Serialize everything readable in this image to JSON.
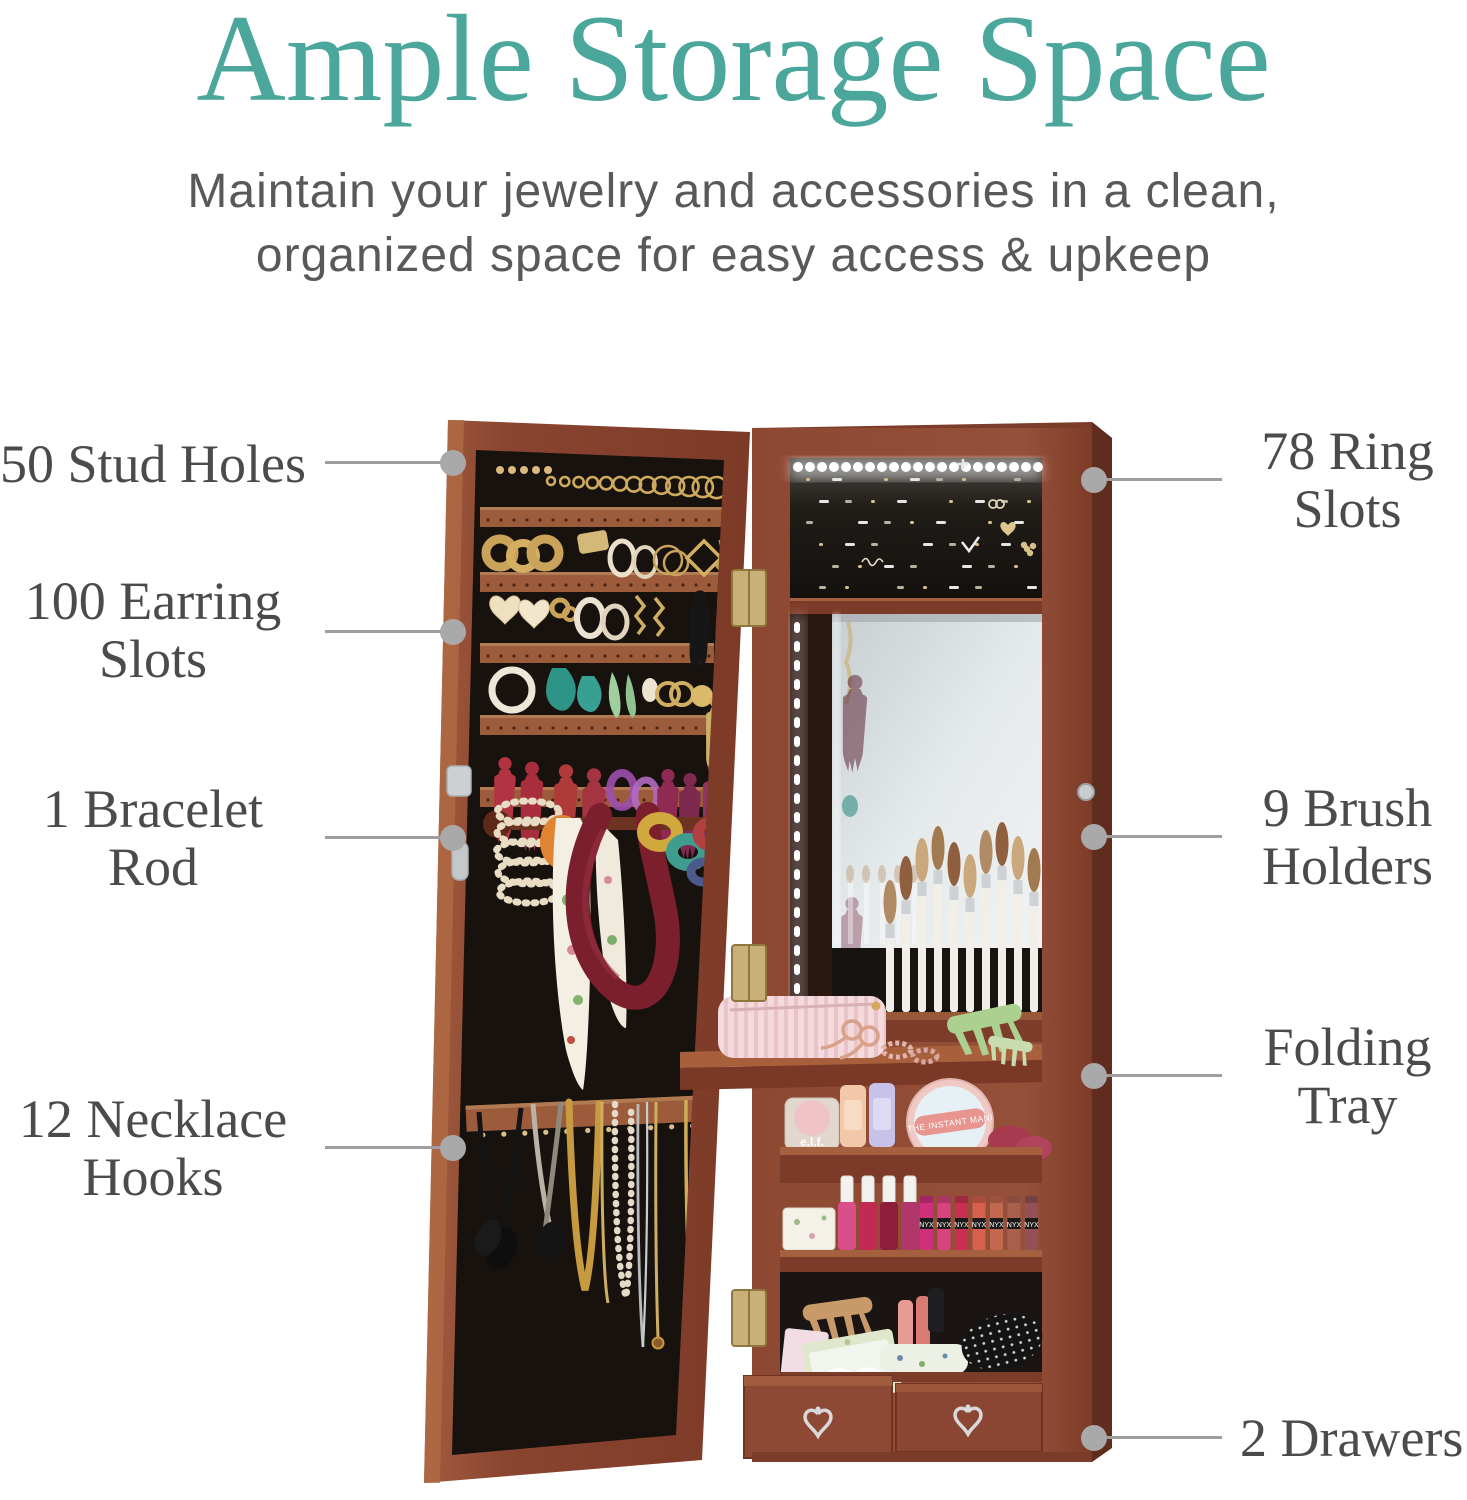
{
  "header": {
    "title": "Ample Storage Space",
    "subtitle_line1": "Maintain your jewelry and accessories in a clean,",
    "subtitle_line2": "organized space for easy access & upkeep"
  },
  "callouts": {
    "left": [
      {
        "line1": "50 Stud Holes"
      },
      {
        "line1": "100 Earring",
        "line2": "Slots"
      },
      {
        "line1": "1 Bracelet",
        "line2": "Rod"
      },
      {
        "line1": "12 Necklace",
        "line2": "Hooks"
      }
    ],
    "right": [
      {
        "line1": "78 Ring",
        "line2": "Slots"
      },
      {
        "line1": "9 Brush",
        "line2": "Holders"
      },
      {
        "line1": "Folding",
        "line2": "Tray"
      },
      {
        "line1": "2 Drawers"
      }
    ]
  },
  "photo_text": {
    "blush_brand": "e.l.f.",
    "mani_tin": "THE INSTANT MANI",
    "lipstick_brand": "NYX"
  },
  "colors": {
    "accent_teal": "#4BA69B",
    "callout_text_gray": "#4B4B4D",
    "subtitle_gray": "#58595B",
    "leader_line_gray": "#9E9E9E",
    "leader_dot_gray": "#A9A9A9",
    "wood_brown": "#8A4733",
    "felt_black": "#17120E"
  }
}
